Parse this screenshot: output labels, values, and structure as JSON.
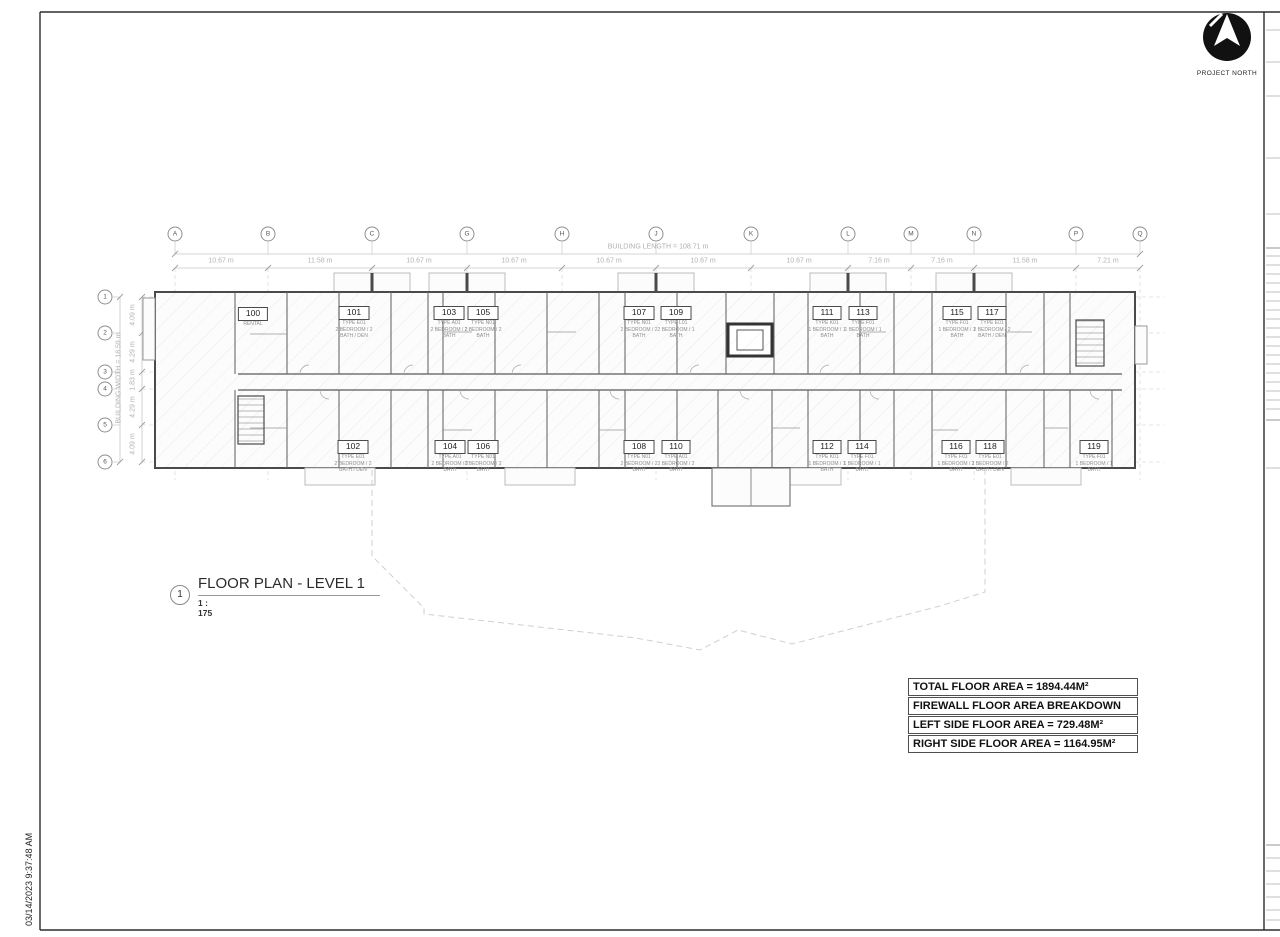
{
  "sheet": {
    "project_north_label": "PROJECT NORTH",
    "timestamp": "03/14/2023 9:37:48 AM"
  },
  "view_title": {
    "detail_number": "1",
    "title": "FLOOR PLAN - LEVEL 1",
    "scale": "1 : 175"
  },
  "area_table": {
    "rows": [
      "TOTAL FLOOR AREA = 1894.44M²",
      "FIREWALL FLOOR AREA BREAKDOWN",
      "LEFT SIDE FLOOR AREA = 729.48M²",
      "RIGHT SIDE FLOOR AREA = 1164.95M²"
    ]
  },
  "grid": {
    "building_length_label": "BUILDING LENGTH = 108.71 m",
    "building_width_label": "BUILDING WIDTH = 18.59 m",
    "columns": [
      "A",
      "B",
      "C",
      "G",
      "H",
      "J",
      "K",
      "L",
      "M",
      "N",
      "P",
      "Q"
    ],
    "column_dims": [
      "10.67 m",
      "11.58 m",
      "10.67 m",
      "10.67 m",
      "10.67 m",
      "10.67 m",
      "10.67 m",
      "7.16 m",
      "7.16 m",
      "11.58 m",
      "7.21 m"
    ],
    "rows": [
      "1",
      "2",
      "3",
      "4",
      "5",
      "6"
    ],
    "row_dims": [
      "4.09 m",
      "4.29 m",
      "1.83 m",
      "4.29 m",
      "4.09 m"
    ]
  },
  "units": [
    {
      "number": "100",
      "lines": [
        "RENTAL"
      ]
    },
    {
      "number": "101",
      "lines": [
        "TYPE E01",
        "2 BEDROOM / 2",
        "BATH / DEN"
      ]
    },
    {
      "number": "102",
      "lines": [
        "TYPE E01",
        "2 BEDROOM / 2",
        "BATH / DEN"
      ]
    },
    {
      "number": "103",
      "lines": [
        "TYPE A01",
        "2 BEDROOM / 2",
        "BATH"
      ]
    },
    {
      "number": "104",
      "lines": [
        "TYPE A01",
        "2 BEDROOM / 2",
        "BATH"
      ]
    },
    {
      "number": "105",
      "lines": [
        "TYPE N01",
        "2 BEDROOM / 2",
        "BATH"
      ]
    },
    {
      "number": "106",
      "lines": [
        "TYPE N01",
        "2 BEDROOM / 2",
        "BATH"
      ]
    },
    {
      "number": "107",
      "lines": [
        "TYPE N01",
        "2 BEDROOM / 2",
        "BATH"
      ]
    },
    {
      "number": "108",
      "lines": [
        "TYPE N01",
        "2 BEDROOM / 2",
        "BATH"
      ]
    },
    {
      "number": "109",
      "lines": [
        "TYPE L01",
        "2 BEDROOM / 1",
        "BATH"
      ]
    },
    {
      "number": "110",
      "lines": [
        "TYPE A01",
        "2 BEDROOM / 2",
        "BATH"
      ]
    },
    {
      "number": "111",
      "lines": [
        "TYPE K01",
        "1 BEDROOM / 1",
        "BATH"
      ]
    },
    {
      "number": "112",
      "lines": [
        "TYPE K01",
        "1 BEDROOM / 1",
        "BATH"
      ]
    },
    {
      "number": "113",
      "lines": [
        "TYPE F01",
        "1 BEDROOM / 1",
        "BATH"
      ]
    },
    {
      "number": "114",
      "lines": [
        "TYPE F01",
        "1 BEDROOM / 1",
        "BATH"
      ]
    },
    {
      "number": "115",
      "lines": [
        "TYPE F01",
        "1 BEDROOM / 1",
        "BATH"
      ]
    },
    {
      "number": "116",
      "lines": [
        "TYPE F01",
        "1 BEDROOM / 1",
        "BATH"
      ]
    },
    {
      "number": "117",
      "lines": [
        "TYPE E01",
        "2 BEDROOM / 2",
        "BATH / DEN"
      ]
    },
    {
      "number": "118",
      "lines": [
        "TYPE E01",
        "2 BEDROOM / 2",
        "BATH / DEN"
      ]
    },
    {
      "number": "119",
      "lines": [
        "TYPE F01",
        "1 BEDROOM / 1",
        "BATH"
      ]
    }
  ]
}
